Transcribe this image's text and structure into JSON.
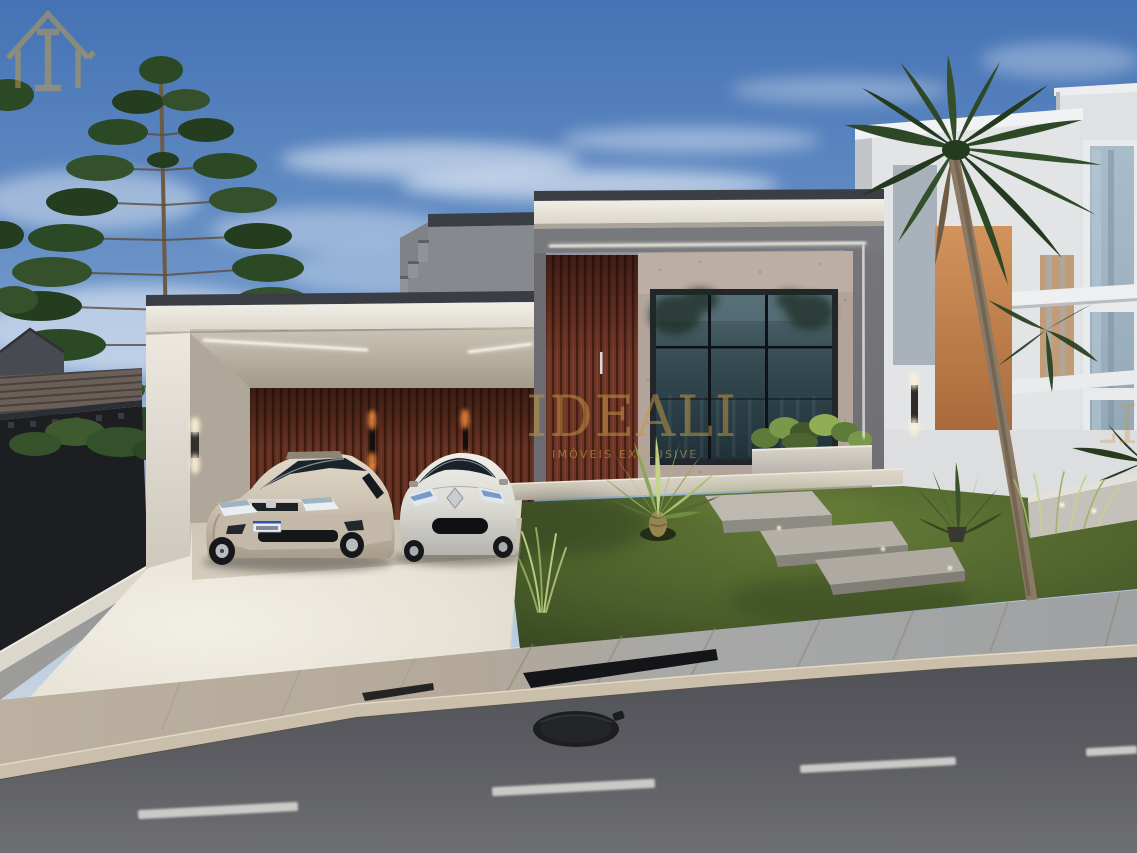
{
  "watermark": {
    "brand": "IDEALI",
    "tagline": "IMÓVEIS EXCLUSIVE",
    "color": "#c49a3f"
  },
  "scene": {
    "description": "Photorealistic dusk render of a modern flat-roof house with open carport, two parked cars, wood-slat accents, large glass window, terraced lawn, sidewalk and asphalt street in the foreground",
    "vehicles": [
      "beige sedan",
      "white hatchback"
    ],
    "landscaping": [
      "araucaria pine trees",
      "palm tree",
      "fountain palm",
      "ornamental grasses",
      "planter shrubs"
    ]
  },
  "palette": {
    "sky_top": "#4472b4",
    "sky_horizon": "#c3d2e2",
    "fascia_white": "#f0ede6",
    "wall_gray": "#8f8f93",
    "wood_slat": "#6e3526",
    "window_glass": "#33484f",
    "lawn_green": "#4b5e2b",
    "driveway": "#ece7da",
    "sidewalk": "#b3a899",
    "asphalt": "#5c5d62",
    "accent_orange": "#c9854e",
    "gold": "#c49a3f"
  }
}
